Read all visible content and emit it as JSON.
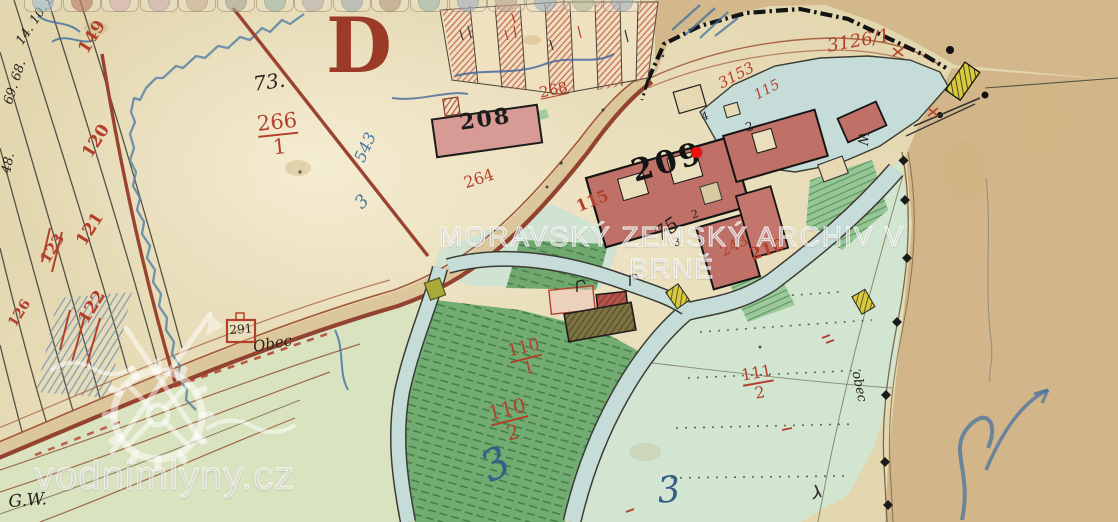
{
  "watermarks": {
    "archive": "MORAVSKÝ ZEMSKÝ ARCHIV V BRNĚ",
    "site": "vodnimlyny.cz"
  },
  "marker": {
    "x": 696,
    "y": 152,
    "color": "#f01010"
  },
  "toolbar": {
    "buttons": [
      {
        "color": "#8fb4d4"
      },
      {
        "color": "#b06050"
      },
      {
        "color": "#d0a8b0"
      },
      {
        "color": "#c8a4ac"
      },
      {
        "color": "#c0a488"
      },
      {
        "color": "#9a9a8a"
      },
      {
        "color": "#88b0a4"
      },
      {
        "color": "#a8a8a8"
      },
      {
        "color": "#92a2b2"
      },
      {
        "color": "#a8896e"
      },
      {
        "color": "#8ab0a8"
      },
      {
        "color": "#92a8c2"
      },
      {
        "color": "#b29a8c"
      },
      {
        "color": "#8aa8ba"
      },
      {
        "color": "#a8b292"
      },
      {
        "color": "#98a8ba"
      }
    ]
  },
  "palette": {
    "paper": "#e3d7b0",
    "paper_dark": "#d2b88c",
    "water": "#c6dcd8",
    "road_edge": "#8e3b28",
    "road_line": "#a2593a",
    "red_ink": "#b3402c",
    "blue_ink": "#4a76a4",
    "black_ink": "#26221c",
    "building": "#bf7168",
    "green_dark": "#72ac72",
    "green_pale": "#d2e5d0",
    "boundary": "#141414",
    "bridge_yellow": "#d8ca3c"
  },
  "map_labels": [
    {
      "name": "parcel-149",
      "text": "149",
      "x": 76,
      "y": 48,
      "rot": -58,
      "size": 17,
      "color": "#b3402c",
      "weight": 700
    },
    {
      "name": "parcel-120",
      "text": "120",
      "x": 80,
      "y": 152,
      "rot": -58,
      "size": 17,
      "color": "#b3402c",
      "weight": 700
    },
    {
      "name": "parcel-121",
      "text": "121",
      "x": 74,
      "y": 240,
      "rot": -58,
      "size": 17,
      "color": "#b3402c",
      "weight": 700
    },
    {
      "name": "parcel-123",
      "text": "123",
      "x": 38,
      "y": 258,
      "rot": -58,
      "size": 15,
      "color": "#b3402c",
      "weight": 700
    },
    {
      "name": "parcel-122",
      "text": "122",
      "x": 76,
      "y": 318,
      "rot": -58,
      "size": 17,
      "color": "#b3402c",
      "weight": 700
    },
    {
      "name": "parcel-126",
      "text": "126",
      "x": 6,
      "y": 322,
      "rot": -58,
      "size": 14,
      "color": "#b3402c",
      "weight": 700
    },
    {
      "name": "note-14-10-9",
      "text": "14. 10. 9.",
      "x": 14,
      "y": 40,
      "rot": -56,
      "size": 13,
      "color": "#26221c",
      "style": "italic"
    },
    {
      "name": "note-69-68",
      "text": "69. 68.",
      "x": 2,
      "y": 102,
      "rot": -72,
      "size": 13,
      "color": "#26221c",
      "style": "italic"
    },
    {
      "name": "note-48",
      "text": "48.",
      "x": 0,
      "y": 172,
      "rot": -78,
      "size": 13,
      "color": "#26221c",
      "style": "italic"
    },
    {
      "name": "note-73",
      "text": "73.",
      "x": 252,
      "y": 74,
      "rot": -8,
      "size": 20,
      "color": "#26221c",
      "style": "italic"
    },
    {
      "name": "section-letter-d",
      "text": "D",
      "x": 326,
      "y": 8,
      "rot": 0,
      "size": 76,
      "color": "#9c3a28",
      "weight": 700
    },
    {
      "name": "parcel-266-1",
      "frac": true,
      "top": "266",
      "bottom": "1",
      "x": 256,
      "y": 114,
      "rot": -6,
      "size": 21,
      "color": "#b3402c"
    },
    {
      "name": "note-543",
      "text": "543",
      "x": 352,
      "y": 158,
      "rot": -66,
      "size": 16,
      "color": "#4a76a4",
      "style": "italic"
    },
    {
      "name": "note-3-blue-a",
      "text": "3",
      "x": 352,
      "y": 200,
      "rot": -45,
      "size": 18,
      "color": "#4a76a4",
      "style": "italic"
    },
    {
      "name": "parcel-208",
      "text": "208",
      "x": 458,
      "y": 112,
      "rot": -8,
      "size": 22,
      "color": "#1c1c1c",
      "weight": 700,
      "ls": 2
    },
    {
      "name": "parcel-268",
      "text": "268",
      "x": 538,
      "y": 86,
      "rot": -12,
      "size": 15,
      "color": "#b3402c",
      "u": true
    },
    {
      "name": "parcel-264",
      "text": "264",
      "x": 462,
      "y": 176,
      "rot": -18,
      "size": 16,
      "color": "#b3402c"
    },
    {
      "name": "parcel-209",
      "text": "209",
      "x": 628,
      "y": 158,
      "rot": -16,
      "size": 31,
      "color": "#141414",
      "weight": 700,
      "ls": 3
    },
    {
      "name": "parcel-3126-1",
      "text": "3126/1",
      "x": 826,
      "y": 38,
      "rot": -10,
      "size": 18,
      "color": "#b3402c",
      "style": "italic"
    },
    {
      "name": "parcel-3153",
      "text": "3153",
      "x": 716,
      "y": 78,
      "rot": -28,
      "size": 15,
      "color": "#b3402c",
      "style": "italic"
    },
    {
      "name": "parcel-115-pond",
      "text": "115",
      "x": 752,
      "y": 90,
      "rot": -28,
      "size": 14,
      "color": "#b3402c",
      "style": "italic"
    },
    {
      "name": "parcel-115-garden",
      "text": "115",
      "x": 574,
      "y": 200,
      "rot": -22,
      "size": 16,
      "color": "#b3402c",
      "weight": 700
    },
    {
      "name": "note-75",
      "text": "75",
      "x": 650,
      "y": 228,
      "rot": -35,
      "size": 20,
      "color": "#26221c",
      "style": "italic"
    },
    {
      "name": "parcel-243",
      "text": "243",
      "x": 718,
      "y": 246,
      "rot": -28,
      "size": 15,
      "color": "#b3402c"
    },
    {
      "name": "parcel-210",
      "text": "210",
      "x": 748,
      "y": 248,
      "rot": -18,
      "size": 17,
      "color": "#b3402c",
      "weight": 700
    },
    {
      "name": "note-w",
      "text": "W",
      "x": 870,
      "y": 132,
      "rot": 95,
      "size": 14,
      "color": "#26221c"
    },
    {
      "name": "parcel-110-1",
      "frac": true,
      "top": "110",
      "bottom": "1",
      "x": 506,
      "y": 344,
      "rot": -14,
      "size": 17,
      "color": "#b3402c"
    },
    {
      "name": "parcel-110-2",
      "frac": true,
      "top": "110",
      "bottom": "2",
      "x": 486,
      "y": 404,
      "rot": -14,
      "size": 20,
      "color": "#b3402c"
    },
    {
      "name": "parcel-111-2",
      "frac": true,
      "top": "111",
      "bottom": "2",
      "x": 740,
      "y": 368,
      "rot": -10,
      "size": 16,
      "color": "#b3402c"
    },
    {
      "name": "note-3-blue-b",
      "text": "3",
      "x": 474,
      "y": 452,
      "rot": -28,
      "size": 42,
      "color": "#355d8a",
      "style": "italic"
    },
    {
      "name": "note-3-blue-c",
      "text": "3",
      "x": 656,
      "y": 474,
      "rot": -5,
      "size": 36,
      "color": "#355d8a",
      "style": "italic"
    },
    {
      "name": "building-291",
      "text": "291",
      "x": 229,
      "y": 324,
      "rot": -4,
      "size": 12,
      "color": "#26221c"
    },
    {
      "name": "note-obec-road",
      "text": "Obec",
      "x": 252,
      "y": 340,
      "rot": -10,
      "size": 15,
      "color": "#26221c",
      "style": "italic"
    },
    {
      "name": "note-obec-path",
      "text": "obec",
      "x": 862,
      "y": 370,
      "rot": 78,
      "size": 13,
      "color": "#26221c",
      "style": "italic"
    },
    {
      "name": "note-gw",
      "text": "G.W.",
      "x": 8,
      "y": 494,
      "rot": -4,
      "size": 17,
      "color": "#26221c",
      "style": "italic"
    },
    {
      "name": "note-4",
      "text": "4",
      "x": 700,
      "y": 112,
      "rot": -16,
      "size": 11,
      "color": "#26221c"
    },
    {
      "name": "note-2a",
      "text": "2",
      "x": 744,
      "y": 122,
      "rot": -16,
      "size": 12,
      "color": "#26221c"
    },
    {
      "name": "note-2b",
      "text": "2",
      "x": 690,
      "y": 210,
      "rot": -16,
      "size": 11,
      "color": "#26221c"
    },
    {
      "name": "note-3-black",
      "text": "3",
      "x": 672,
      "y": 238,
      "rot": -16,
      "size": 11,
      "color": "#26221c"
    }
  ]
}
